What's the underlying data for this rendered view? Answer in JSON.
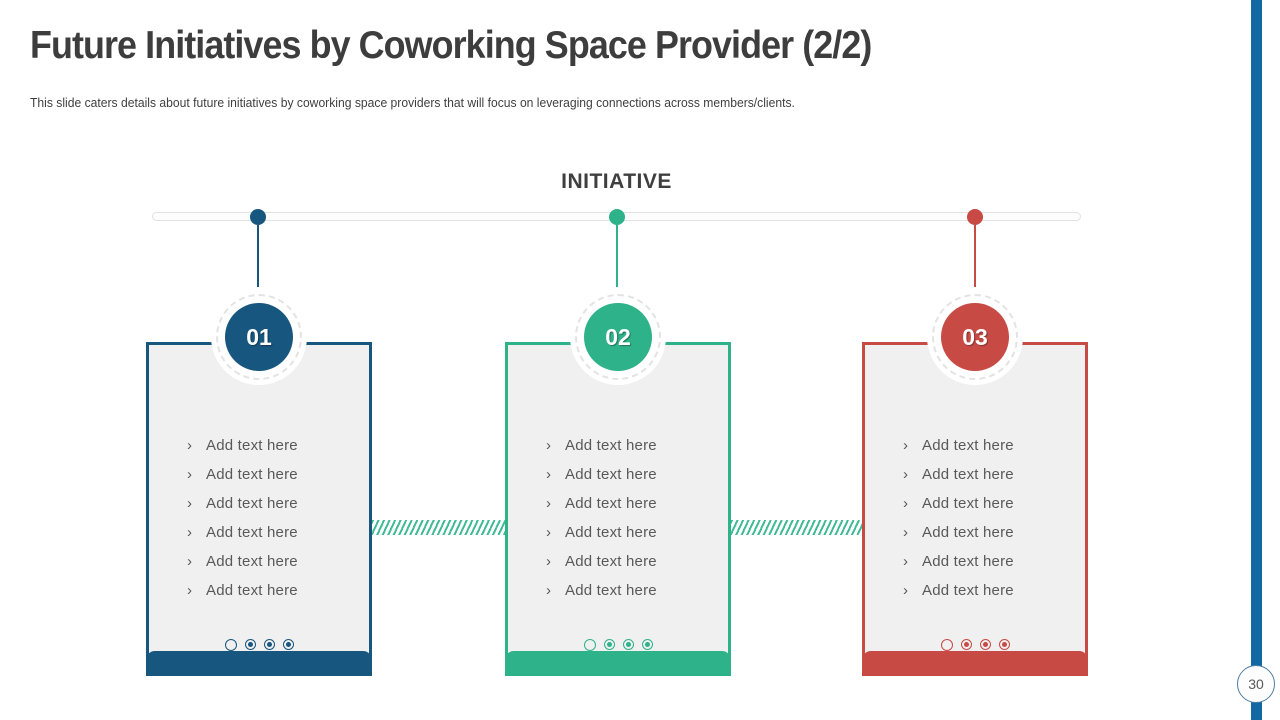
{
  "slide": {
    "title": "Future Initiatives by Coworking Space Provider (2/2)",
    "subtitle": "This slide caters details about future initiatives by coworking space providers that will focus on leveraging connections across members/clients.",
    "page_number": "30"
  },
  "diagram": {
    "heading": "INITIATIVE",
    "bullet_char": "›",
    "cards": [
      {
        "number": "01",
        "color": "#17567F",
        "items": [
          "Add text here",
          "Add text here",
          "Add text here",
          "Add text here",
          "Add text here",
          "Add text here"
        ],
        "footer_icons": [
          "circle-outline",
          "bullseye",
          "bullseye",
          "bullseye"
        ]
      },
      {
        "number": "02",
        "color": "#2DB289",
        "items": [
          "Add text here",
          "Add text here",
          "Add text here",
          "Add text here",
          "Add text here",
          "Add text here"
        ],
        "footer_icons": [
          "circle-outline",
          "bullseye",
          "bullseye",
          "bullseye"
        ]
      },
      {
        "number": "03",
        "color": "#C84A45",
        "items": [
          "Add text here",
          "Add text here",
          "Add text here",
          "Add text here",
          "Add text here",
          "Add text here"
        ],
        "footer_icons": [
          "circle-outline",
          "bullseye",
          "bullseye",
          "bullseye"
        ]
      }
    ]
  },
  "colors": {
    "blue": "#17567F",
    "teal": "#2DB289",
    "red": "#C84A45",
    "accent_bar": "#1269A2",
    "card_background": "#F0F0F0",
    "body_text": "#595959",
    "title_text": "#3D3D3D"
  }
}
